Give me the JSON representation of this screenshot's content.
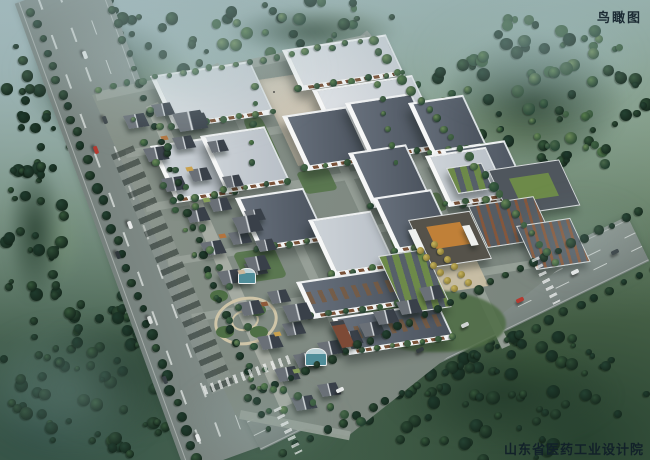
{
  "labels": {
    "view_title": "鸟瞰图",
    "credit": "山东省医药工业设计院"
  },
  "palette": {
    "road": "#848f8b",
    "road_se": "#8c9691",
    "road_ne": "#8d978f",
    "campus_paving_a": "#8a948b",
    "campus_paving_b": "#76817a",
    "pedestrian_street": "#a5aba2",
    "street": "#97a098",
    "plaza": "#cec7b7",
    "entrance_plaza": "#c9bfa4",
    "roof_light_a": "#dde1e5",
    "roof_light_b": "#c6ccd2",
    "roof_gray_a": "#cdd3d8",
    "roof_gray_b": "#b8bfc7",
    "roof_dark_a": "#67707c",
    "roof_dark_b": "#4b535e",
    "parapet": "#eef0f1",
    "window_band": "#7a5238",
    "shop_roof_light": "#6a7077",
    "shop_roof_dark": "#394049",
    "shop_ridge": "#d8dcdf",
    "brick": "#84573d",
    "green_roof": "#6d8a49",
    "gate_roof": "#55524a",
    "gate_skylight": "#c08038",
    "glass_teal": "#4f8d99",
    "lawn": "#55744a",
    "tree_light": [
      "#6b8a58",
      "#567c4b",
      "#49684a",
      "#3f6342"
    ],
    "tree_dark": [
      "#35573a",
      "#2c4a34",
      "#244232",
      "#1e3a2c"
    ],
    "yellow_tree": [
      "#c7b45c",
      "#8a7a35"
    ],
    "lane_mark": "rgba(250,253,251,.6)"
  },
  "scene": {
    "fields": [
      {
        "x": 60,
        "y": 40,
        "w": 180,
        "h": 90,
        "c": "#93ab7c",
        "o": 0.45
      },
      {
        "x": 430,
        "y": 80,
        "w": 180,
        "h": 95,
        "c": "#8ea473",
        "o": 0.4
      },
      {
        "x": 250,
        "y": 0,
        "w": 170,
        "h": 55,
        "c": "#8aa077",
        "o": 0.35
      },
      {
        "x": 28,
        "y": 180,
        "w": 64,
        "h": 120,
        "c": "#7d9a74",
        "o": 0.35
      },
      {
        "x": 470,
        "y": 330,
        "w": 130,
        "h": 80,
        "c": "#3d5c3a",
        "o": 0.45
      }
    ],
    "forests": [
      {
        "x": 0,
        "y": 0,
        "w": 215,
        "h": 160,
        "count": 72,
        "seed": 11,
        "shade": "dark"
      },
      {
        "x": 415,
        "y": 15,
        "w": 235,
        "h": 175,
        "count": 84,
        "seed": 22,
        "shade": "mixed"
      },
      {
        "x": 0,
        "y": 295,
        "w": 235,
        "h": 165,
        "count": 78,
        "seed": 33,
        "shade": "dark"
      },
      {
        "x": 355,
        "y": 330,
        "w": 295,
        "h": 130,
        "count": 72,
        "seed": 44,
        "shade": "dark"
      },
      {
        "x": 0,
        "y": 140,
        "w": 70,
        "h": 180,
        "count": 30,
        "seed": 55,
        "shade": "dark"
      },
      {
        "x": 205,
        "y": 0,
        "w": 215,
        "h": 62,
        "count": 26,
        "seed": 66,
        "shade": "mixed"
      }
    ],
    "roads": [
      {
        "x": 58,
        "y": -12,
        "len": 500,
        "w": 92,
        "a": 70,
        "c": "#848f8b",
        "lanes": 3
      },
      {
        "x": 250,
        "y": 428,
        "len": 432,
        "w": 50,
        "a": -26,
        "c": "#8c9691",
        "lanes": 2
      },
      {
        "x": 362,
        "y": 34,
        "len": 300,
        "w": 13,
        "a": 50,
        "c": "#8d978f",
        "lanes": 0
      }
    ],
    "campus_polygon": "92,95 368,38 560,268 348,436 236,416",
    "streets": [
      {
        "x": 96,
        "y": 96,
        "len": 276,
        "w": 9,
        "a": -12
      },
      {
        "x": 126,
        "y": 154,
        "len": 330,
        "w": 8,
        "a": -9
      },
      {
        "x": 146,
        "y": 208,
        "len": 350,
        "w": 8,
        "a": -9
      },
      {
        "x": 168,
        "y": 262,
        "len": 360,
        "w": 8,
        "a": -9
      },
      {
        "x": 192,
        "y": 318,
        "len": 345,
        "w": 8,
        "a": -9
      },
      {
        "x": 240,
        "y": 414,
        "len": 112,
        "w": 9,
        "a": 11
      },
      {
        "x": 214,
        "y": 64,
        "len": 300,
        "w": 9,
        "a": 65
      },
      {
        "x": 289,
        "y": 50,
        "len": 330,
        "w": 9,
        "a": 65
      },
      {
        "x": 364,
        "y": 42,
        "len": 336,
        "w": 9,
        "a": 65
      }
    ],
    "pedestrian_street": {
      "x": 152,
      "y": 104,
      "len": 330,
      "w": 13,
      "a": 66
    },
    "parking": {
      "x": 122,
      "y": 150,
      "len": 260,
      "w": 24,
      "a": 67
    },
    "plaza": {
      "x": 258,
      "y": 80,
      "w": 120,
      "h": 86,
      "people": 10
    },
    "entrance_plaza": {
      "x": 412,
      "y": 246,
      "w": 58,
      "h": 48
    },
    "south_green": {
      "x": 366,
      "y": 290,
      "w": 140,
      "h": 62
    },
    "lawns": [
      {
        "x": 252,
        "y": 118,
        "w": 20,
        "h": 44
      },
      {
        "x": 238,
        "y": 250,
        "w": 44,
        "h": 30
      },
      {
        "x": 300,
        "y": 170,
        "w": 34,
        "h": 22
      },
      {
        "x": 416,
        "y": 194,
        "w": 28,
        "h": 18
      },
      {
        "x": 392,
        "y": 238,
        "w": 20,
        "h": 14
      },
      {
        "x": 458,
        "y": 148,
        "w": 24,
        "h": 16
      }
    ],
    "garden": {
      "cx": 243,
      "cy": 318,
      "outer_w": 58,
      "outer_h": 42,
      "inner_w": 24,
      "inner_h": 17
    },
    "factories": [
      {
        "x": 150,
        "y": 76,
        "w": 100,
        "h": 46,
        "roof": "light"
      },
      {
        "x": 282,
        "y": 50,
        "w": 104,
        "h": 34,
        "roof": "light"
      },
      {
        "x": 312,
        "y": 90,
        "w": 100,
        "h": 34,
        "roof": "light"
      },
      {
        "x": 150,
        "y": 146,
        "w": 60,
        "h": 50,
        "roof": "gray"
      },
      {
        "x": 200,
        "y": 136,
        "w": 62,
        "h": 50,
        "roof": "gray"
      },
      {
        "x": 282,
        "y": 116,
        "w": 62,
        "h": 48,
        "roof": "dark"
      },
      {
        "x": 345,
        "y": 103,
        "w": 64,
        "h": 50,
        "roof": "dark"
      },
      {
        "x": 408,
        "y": 103,
        "w": 52,
        "h": 46,
        "roof": "dark"
      },
      {
        "x": 440,
        "y": 150,
        "w": 62,
        "h": 50,
        "roof": "dark"
      },
      {
        "x": 348,
        "y": 153,
        "w": 55,
        "h": 48,
        "roof": "dark"
      },
      {
        "x": 425,
        "y": 156,
        "w": 58,
        "h": 44,
        "roof": "gray"
      },
      {
        "x": 235,
        "y": 198,
        "w": 66,
        "h": 46,
        "roof": "dark"
      },
      {
        "x": 308,
        "y": 220,
        "w": 60,
        "h": 50,
        "roof": "gray"
      },
      {
        "x": 372,
        "y": 198,
        "w": 56,
        "h": 48,
        "roof": "dark"
      },
      {
        "x": 296,
        "y": 282,
        "w": 104,
        "h": 30,
        "roof": "dark",
        "band": true
      },
      {
        "x": 332,
        "y": 318,
        "w": 106,
        "h": 30,
        "roof": "dark",
        "band": true
      }
    ],
    "east_buildings": [
      {
        "x": 488,
        "y": 170,
        "w": 74,
        "h": 44,
        "style": "courtyard"
      },
      {
        "x": 446,
        "y": 168,
        "w": 36,
        "h": 24,
        "style": "greenrows"
      },
      {
        "x": 468,
        "y": 206,
        "w": 68,
        "h": 40,
        "style": "brickrows"
      },
      {
        "x": 516,
        "y": 226,
        "w": 56,
        "h": 42,
        "style": "brick2"
      },
      {
        "x": 408,
        "y": 220,
        "w": 64,
        "h": 46,
        "style": "gate"
      },
      {
        "x": 378,
        "y": 256,
        "w": 48,
        "h": 56,
        "style": "greenrows"
      }
    ],
    "gate_towers": [
      {
        "x": 408,
        "y": 230,
        "w": 8,
        "h": 20
      },
      {
        "x": 462,
        "y": 226,
        "w": 8,
        "h": 20
      }
    ],
    "shop_lines": [
      {
        "x1": 126,
        "y1": 116,
        "x2": 292,
        "y2": 398,
        "n": 10,
        "w": 22,
        "h": 13
      },
      {
        "x1": 154,
        "y1": 106,
        "x2": 320,
        "y2": 386,
        "n": 10,
        "w": 20,
        "h": 12
      },
      {
        "x1": 296,
        "y1": 352,
        "x2": 416,
        "y2": 290,
        "n": 7,
        "w": 22,
        "h": 13
      },
      {
        "x1": 190,
        "y1": 112,
        "x2": 258,
        "y2": 240,
        "n": 5,
        "w": 18,
        "h": 11
      }
    ],
    "shop_anchors": [
      {
        "x": 172,
        "y": 114,
        "w": 30,
        "h": 18
      },
      {
        "x": 232,
        "y": 218,
        "w": 26,
        "h": 16
      },
      {
        "x": 282,
        "y": 306,
        "w": 26,
        "h": 16
      },
      {
        "x": 244,
        "y": 258,
        "w": 22,
        "h": 14
      }
    ],
    "glass_pavilions": [
      {
        "x": 238,
        "y": 268,
        "w": 16,
        "h": 14
      },
      {
        "x": 305,
        "y": 348,
        "w": 20,
        "h": 16
      }
    ],
    "brick_tower": {
      "x": 330,
      "y": 322,
      "w": 14,
      "h": 22
    },
    "stalls": {
      "x1": 165,
      "y1": 135,
      "x2": 295,
      "y2": 368,
      "n": 8,
      "colors": [
        "#b3743e",
        "#c9a14e",
        "#87a059",
        "#b3743e",
        "#cbb79a",
        "#8f5a3a",
        "#c9a14e",
        "#87a059"
      ]
    },
    "treelines": [
      {
        "x1": 32,
        "y1": 12,
        "x2": 196,
        "y2": 458,
        "n": 34,
        "r": 4.5,
        "shade": "dark"
      },
      {
        "x1": 112,
        "y1": 10,
        "x2": 268,
        "y2": 430,
        "n": 30,
        "r": 3.5,
        "shade": "dark"
      },
      {
        "x1": 250,
        "y1": 398,
        "x2": 640,
        "y2": 212,
        "n": 30,
        "r": 4,
        "shade": "dark"
      },
      {
        "x1": 282,
        "y1": 452,
        "x2": 655,
        "y2": 268,
        "n": 26,
        "r": 4,
        "shade": "dark"
      },
      {
        "x1": 372,
        "y1": 42,
        "x2": 556,
        "y2": 262,
        "n": 24,
        "r": 4,
        "shade": "light"
      },
      {
        "x1": 100,
        "y1": 88,
        "x2": 360,
        "y2": 42,
        "n": 20,
        "r": 3,
        "shade": "light"
      },
      {
        "x1": 150,
        "y1": 108,
        "x2": 282,
        "y2": 408,
        "n": 16,
        "r": 3.5,
        "shade": "light"
      },
      {
        "x1": 134,
        "y1": 120,
        "x2": 270,
        "y2": 410,
        "n": 14,
        "r": 3,
        "shade": "light"
      },
      {
        "x1": 256,
        "y1": 86,
        "x2": 250,
        "y2": 162,
        "n": 5,
        "r": 3,
        "shade": "light"
      },
      {
        "x1": 378,
        "y1": 84,
        "x2": 396,
        "y2": 162,
        "n": 6,
        "r": 3,
        "shade": "light"
      },
      {
        "x1": 250,
        "y1": 380,
        "x2": 360,
        "y2": 420,
        "n": 8,
        "r": 4,
        "shade": "light"
      }
    ],
    "yellow_treelines": [
      {
        "x1": 420,
        "y1": 250,
        "x2": 454,
        "y2": 288,
        "n": 6,
        "r": 3.5
      },
      {
        "x1": 434,
        "y1": 244,
        "x2": 468,
        "y2": 282,
        "n": 6,
        "r": 3.5
      }
    ],
    "cars": [
      {
        "x": 85,
        "y": 55,
        "a": 70,
        "c": "#e4e7e6"
      },
      {
        "x": 105,
        "y": 120,
        "a": 70,
        "c": "#3a4246"
      },
      {
        "x": 96,
        "y": 150,
        "a": 70,
        "c": "#b43a30"
      },
      {
        "x": 130,
        "y": 225,
        "a": 70,
        "c": "#e8eaea"
      },
      {
        "x": 118,
        "y": 255,
        "a": 70,
        "c": "#2f373b"
      },
      {
        "x": 150,
        "y": 320,
        "a": 70,
        "c": "#d8dcda"
      },
      {
        "x": 165,
        "y": 380,
        "a": 70,
        "c": "#3a4246"
      },
      {
        "x": 198,
        "y": 438,
        "a": 70,
        "c": "#e8eaea"
      },
      {
        "x": 340,
        "y": 390,
        "a": -26,
        "c": "#e8eaea"
      },
      {
        "x": 420,
        "y": 350,
        "a": -26,
        "c": "#343c40"
      },
      {
        "x": 465,
        "y": 325,
        "a": -26,
        "c": "#d0d4d2"
      },
      {
        "x": 520,
        "y": 300,
        "a": -26,
        "c": "#b43a30"
      },
      {
        "x": 575,
        "y": 272,
        "a": -26,
        "c": "#e8eaea"
      },
      {
        "x": 615,
        "y": 252,
        "a": -26,
        "c": "#3a4246"
      }
    ],
    "crosswalks": [
      {
        "x": 250,
        "y": 390,
        "len": 92,
        "w": 9,
        "a": -20
      },
      {
        "x": 560,
        "y": 258,
        "len": 50,
        "w": 8,
        "a": 64
      },
      {
        "x": 302,
        "y": 408,
        "len": 50,
        "w": 8,
        "a": 64
      }
    ],
    "haze": [
      {
        "x": -40,
        "y": -30,
        "w": 420,
        "h": 200,
        "c": "rgba(168,192,193,.42)"
      },
      {
        "x": 380,
        "y": -20,
        "w": 300,
        "h": 160,
        "c": "rgba(160,186,190,.35)"
      },
      {
        "x": -60,
        "y": 300,
        "w": 260,
        "h": 180,
        "c": "rgba(130,160,160,.38)"
      },
      {
        "x": 150,
        "y": 360,
        "w": 220,
        "h": 120,
        "c": "rgba(140,168,165,.25)"
      },
      {
        "x": 480,
        "y": 180,
        "w": 200,
        "h": 120,
        "c": "rgba(150,175,175,.22)"
      }
    ]
  }
}
